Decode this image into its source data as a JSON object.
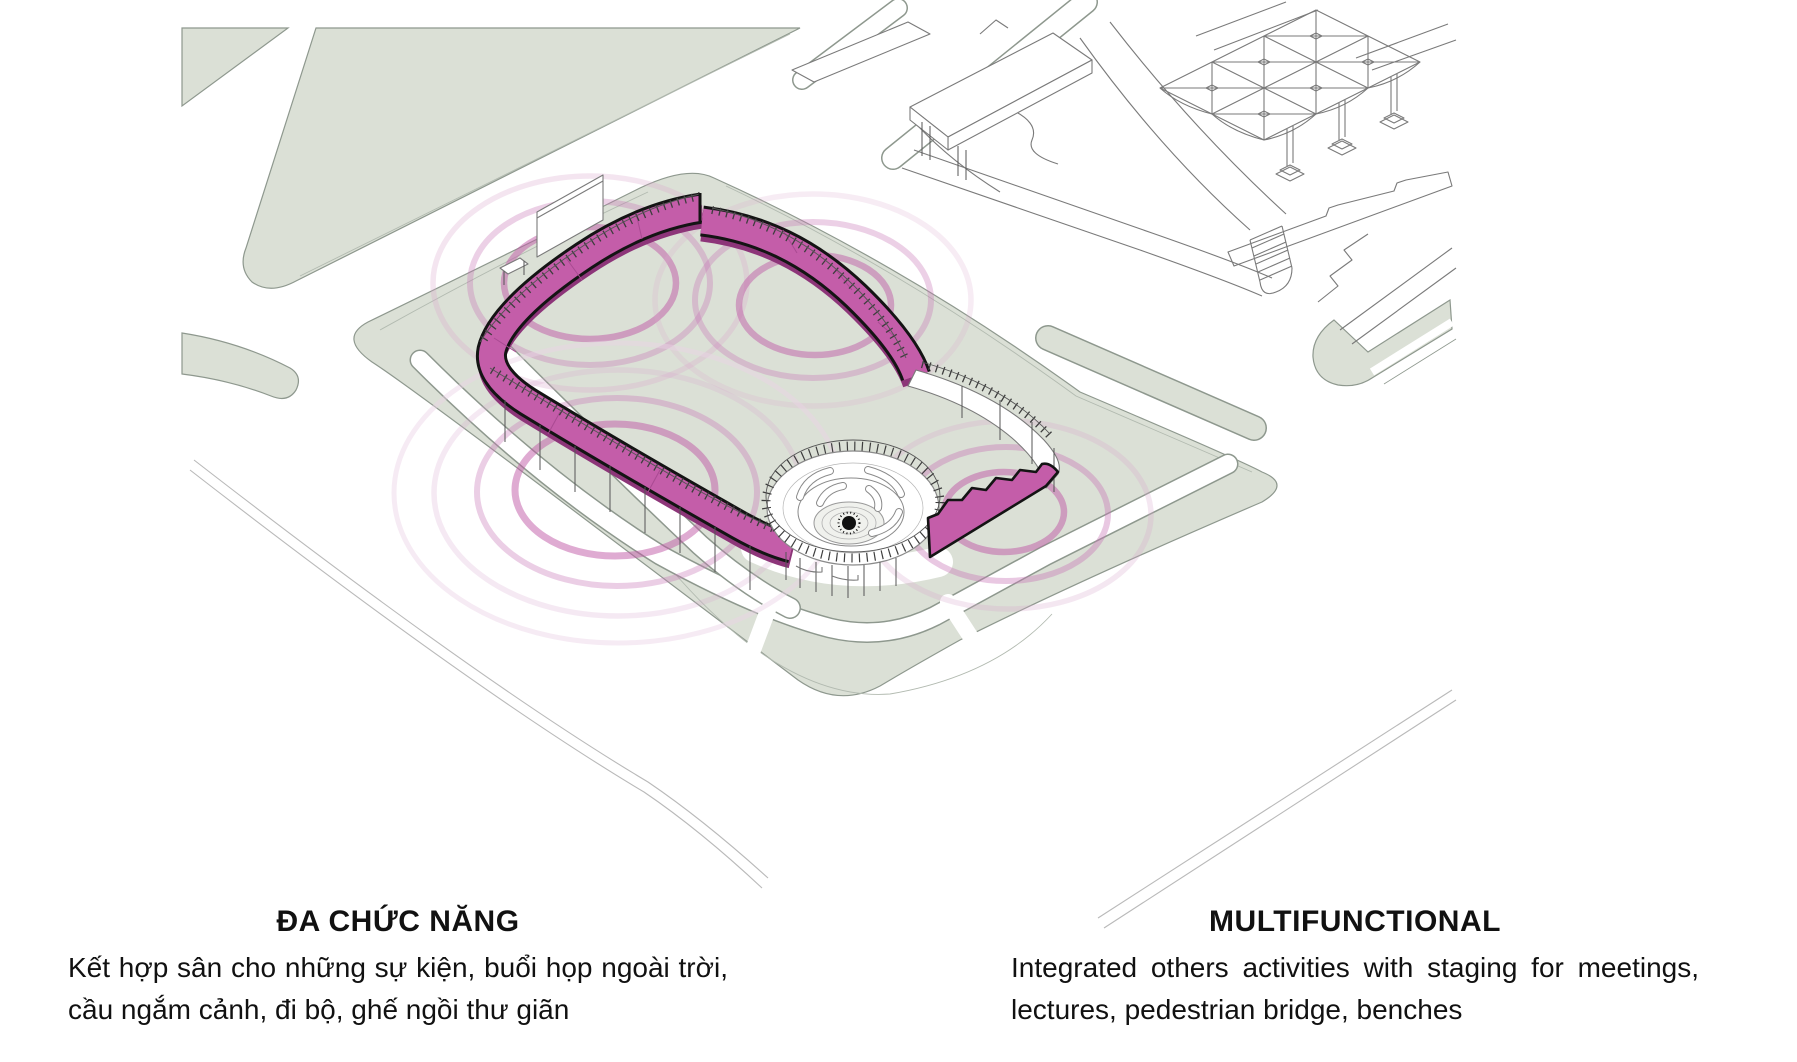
{
  "page": {
    "background": "#ffffff"
  },
  "illustration": {
    "type": "isometric-site-diagram",
    "highlight_color": "#c45da9",
    "outline_color": "#141414",
    "ground_color": "#dbe0d6",
    "edge_color": "#8e988e",
    "line_color": "#7a7a7a",
    "ripple_color": "#bf58a6",
    "ripple_soft_color": "#d9a8ce"
  },
  "captions": {
    "vi": {
      "title": "ĐA CHỨC NĂNG",
      "body": "Kết hợp sân cho những sự kiện, buổi họp ngoài trời, cầu ngắm cảnh, đi bộ, ghế ngồi thư giãn"
    },
    "en": {
      "title": "MULTIFUNCTIONAL",
      "body": "Integrated others activities with staging for meetings, lectures, pedestrian bridge, benches"
    }
  }
}
